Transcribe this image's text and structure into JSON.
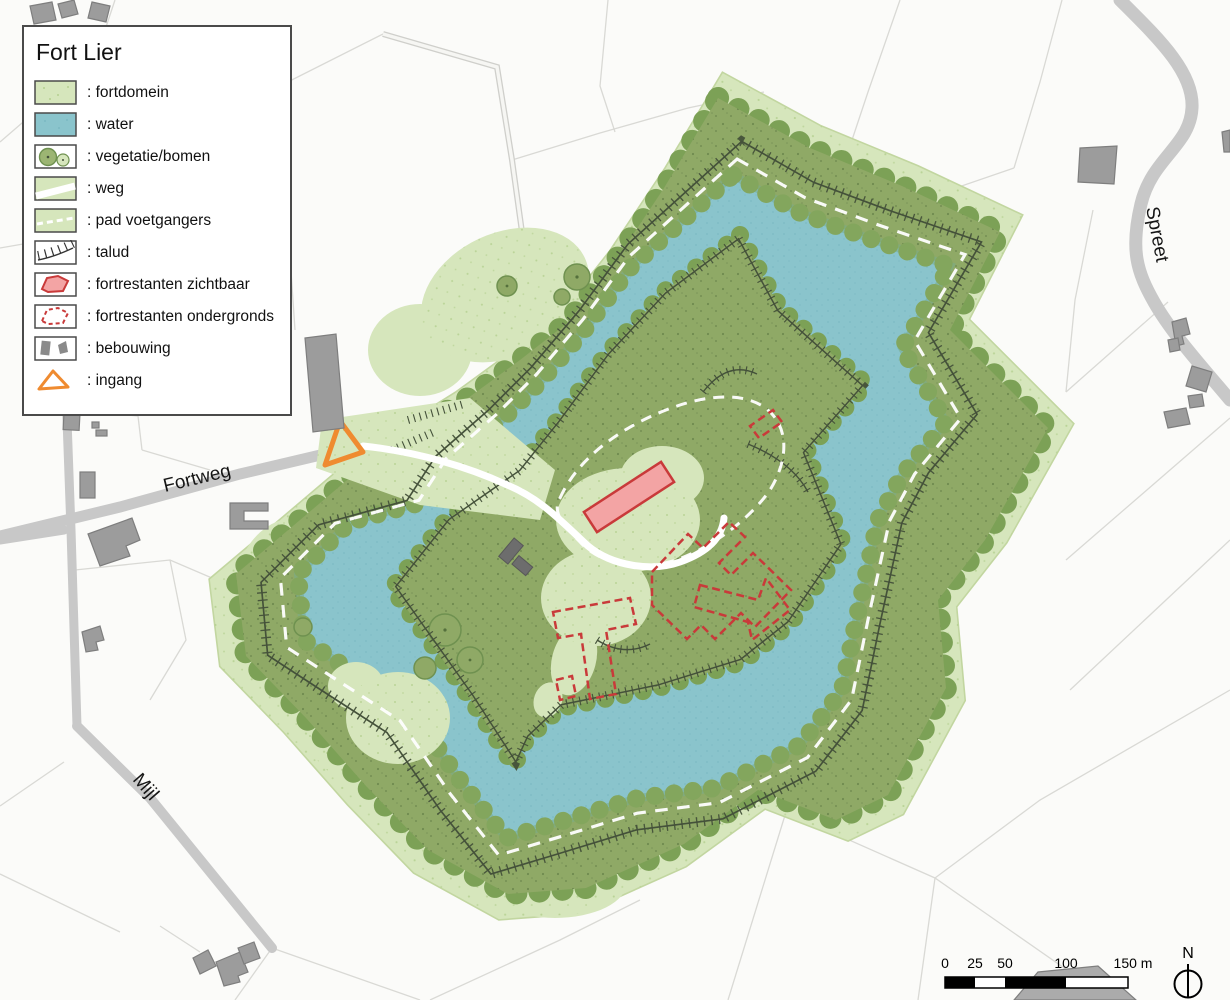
{
  "legend": {
    "title": "Fort Lier",
    "items": [
      {
        "key": "fortdomein",
        "label": ": fortdomein"
      },
      {
        "key": "water",
        "label": ": water"
      },
      {
        "key": "vegetatie-bomen",
        "label": ": vegetatie/bomen"
      },
      {
        "key": "weg",
        "label": ": weg"
      },
      {
        "key": "pad-voetgangers",
        "label": ": pad voetgangers"
      },
      {
        "key": "talud",
        "label": ": talud"
      },
      {
        "key": "fortrestanten-zichtbaar",
        "label": ": fortrestanten zichtbaar"
      },
      {
        "key": "fortrestanten-ondergronds",
        "label": ": fortrestanten ondergronds"
      },
      {
        "key": "bebouwing",
        "label": ": bebouwing"
      },
      {
        "key": "ingang",
        "label": ": ingang"
      }
    ]
  },
  "map_labels": {
    "fortweg": "Fortweg",
    "mijl": "Mijl",
    "spreet": "Spreet"
  },
  "scale_bar": {
    "ticks": [
      "0",
      "25",
      "50",
      "100",
      "150 m"
    ]
  },
  "compass": {
    "label": "N"
  },
  "colors": {
    "fortdomein": "#d6e6bc",
    "water": "#8ac4cc",
    "ring_green": "#8fa966",
    "canopy": "#7ca156",
    "talud": "#44513a",
    "remains_visible_fill": "#f3a4a4",
    "remains_stroke": "#c93a3a",
    "building": "#9c9c9c",
    "entrance_orange": "#ef8b30",
    "road_gray": "#c8c8c8"
  }
}
